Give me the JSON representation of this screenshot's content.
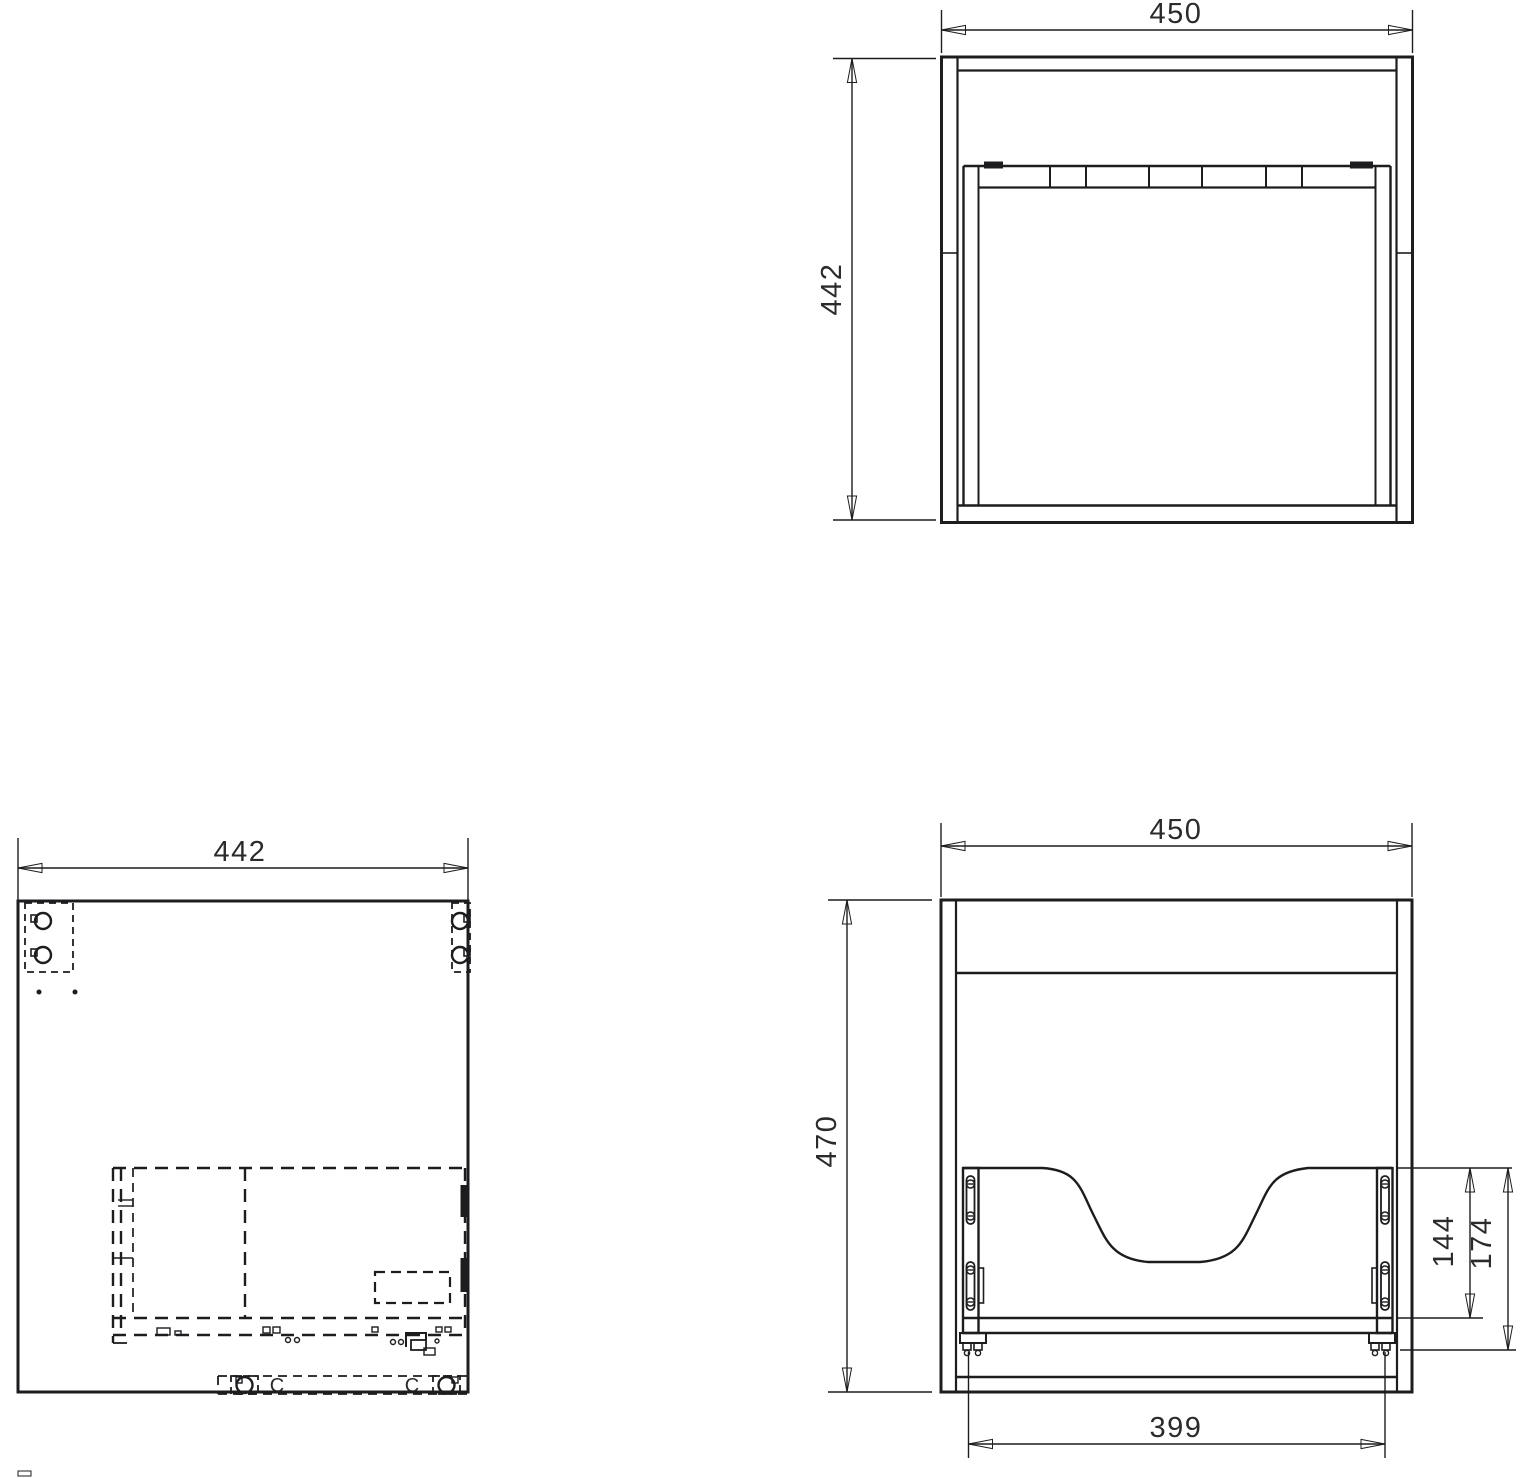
{
  "colors": {
    "line_color": "#1d1d20",
    "text_color": "#2b2b2e",
    "background_color": "#ffffff",
    "artifact_color": "#1e3a5f"
  },
  "icons": {
    "cam_lock": "circle-with-tab-in-dashed-box",
    "screw": "circle-cross-head",
    "arrowhead": "slim-filled-triangle"
  },
  "views": {
    "carcass_front": {
      "width_dim": "450",
      "height_dim": "442"
    },
    "carcass_plan": {
      "width_dim": "442",
      "cam_letter_left": "C",
      "cam_letter_right": "C"
    },
    "basin_front": {
      "width_dim": "450",
      "height_dim": "470",
      "cutout_height_dim": "144",
      "rail_offset_dim": "174",
      "runner_span_dim": "399"
    }
  }
}
